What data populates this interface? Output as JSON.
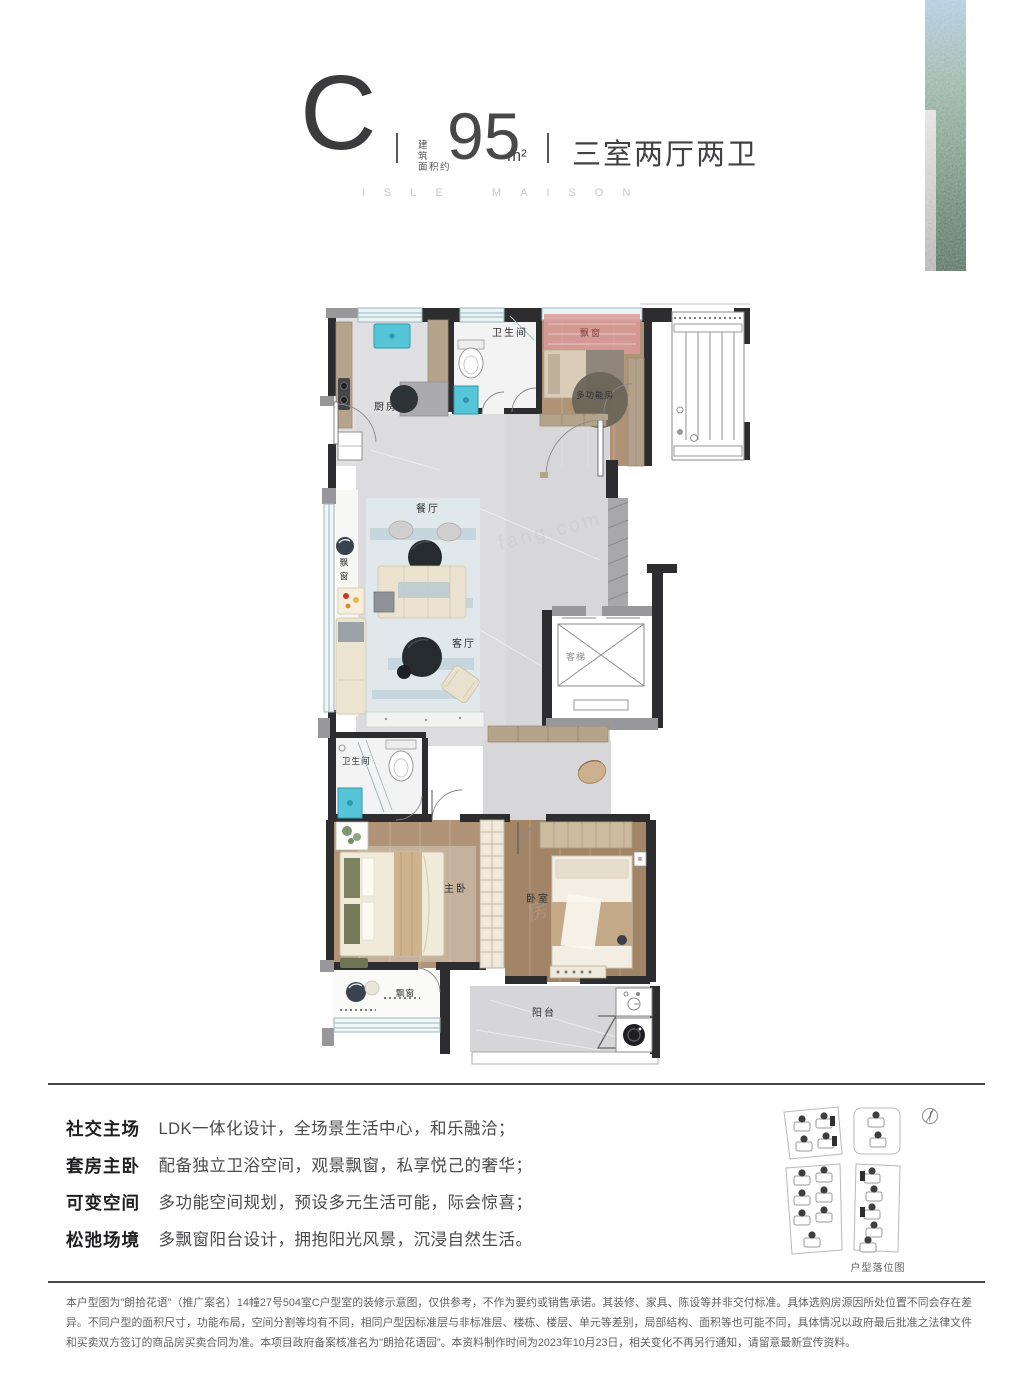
{
  "header": {
    "type_letter": "C",
    "area_label_line1": "建筑",
    "area_label_line2": "面积约",
    "area_value": "95",
    "area_unit": "m²",
    "layout": "三室两厅两卫",
    "brand": "ISLE MAISON"
  },
  "floor_plan": {
    "rooms": {
      "kitchen": "厨房",
      "bath_top": "卫生间",
      "bay_top": "飘窗",
      "multi_room": "多功能房",
      "dining": "餐厅",
      "bay_left": "飘窗",
      "living": "客厅",
      "elevator": "客梯",
      "bath_bottom": "卫生间",
      "master": "主卧",
      "bedroom": "卧室",
      "bay_bottom": "飘窗",
      "balcony": "阳台"
    },
    "watermark_1": "房天下",
    "watermark_2": "fang.com"
  },
  "features": [
    {
      "label": "社交主场",
      "desc": "LDK一体化设计，全场景生活中心，和乐融洽；"
    },
    {
      "label": "套房主卧",
      "desc": "配备独立卫浴空间，观景飘窗，私享悦己的奢华；"
    },
    {
      "label": "可变空间",
      "desc": "多功能空间规划，预设多元生活可能，际会惊喜；"
    },
    {
      "label": "松弛场境",
      "desc": "多飘窗阳台设计，拥抱阳光风景，沉浸自然生活。"
    }
  ],
  "site_plan": {
    "caption": "户型落位图"
  },
  "disclaimer": "本户型图为\"朗拾花语\"（推广案名）14幢27号504室C户型室的装修示意图，仅供参考，不作为要约或销售承诺。其装修、家具、陈设等并非交付标准。具体选购房源因所处位置不同会存在差异。不同户型的面积尺寸，功能布局，空间分割等均有不同，相同户型因标准层与非标准层、楼栋、楼层、单元等差别，局部结构、面积等也可能不同，具体情况以政府最后批准之法律文件和买卖双方签订的商品房买卖合同为准。本项目政府备案核准名为\"朗拾花语园\"。本资料制作时间为2023年10月23日，相关变化不再另行通知，请留意最新宣传资料。",
  "colors": {
    "text_dark": "#3b3b3d",
    "brand_gray": "#c9c9c9",
    "wall": "#2d2d30",
    "teal_fixture": "#57c5d8",
    "bay_pink": "#dc9a9a",
    "wood": "#b19478",
    "marble": "#d9d9db",
    "glass_green": "#4c6f58"
  }
}
